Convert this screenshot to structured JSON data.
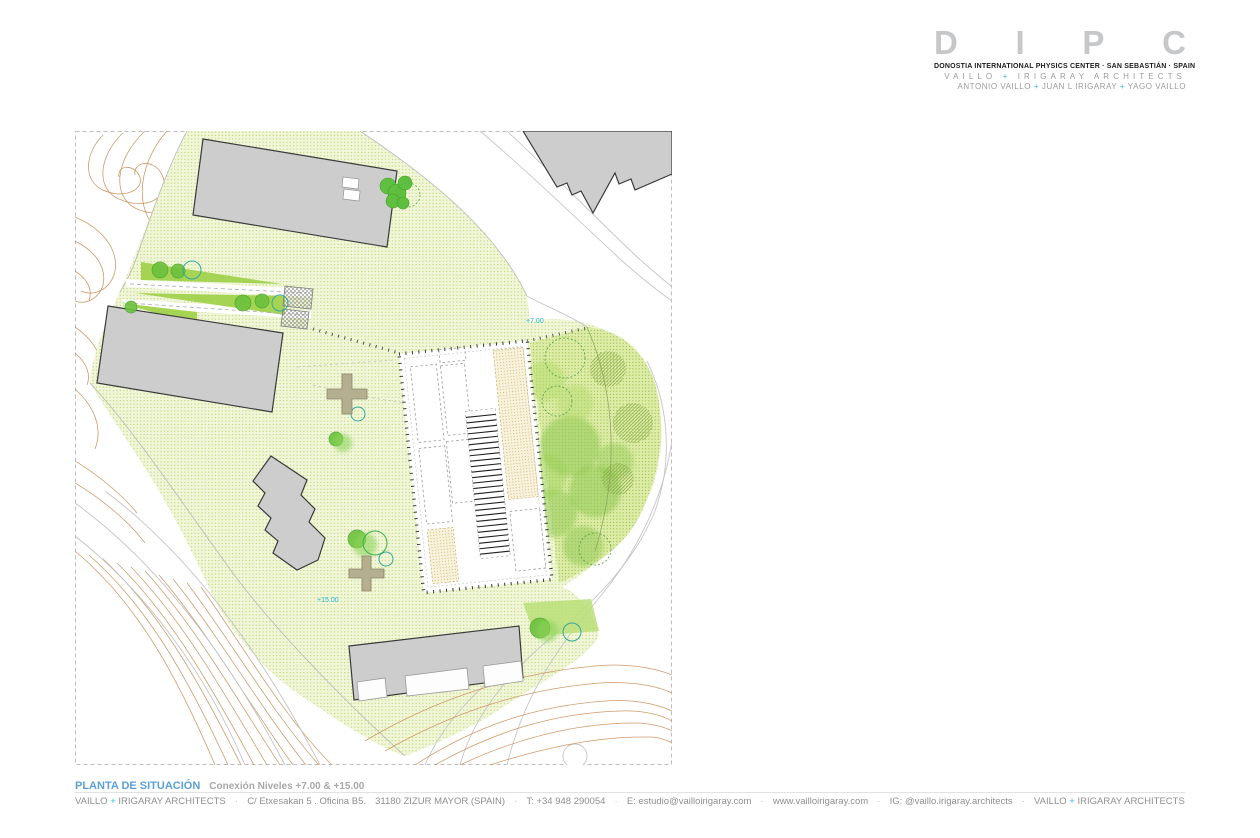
{
  "header": {
    "logo_letters": [
      "D",
      "I",
      "P",
      "C"
    ],
    "subtitle": "DONOSTIA INTERNATIONAL PHYSICS CENTER · SAN SEBASTIÁN · SPAIN",
    "firm_line": {
      "a": "VAILLO",
      "plus": "+",
      "b": "IRIGARAY ARCHITECTS"
    },
    "partners_line": {
      "a": "ANTONIO VAILLO",
      "plus1": "+",
      "b": "JUAN L IRIGARAY",
      "plus2": "+",
      "c": "YAGO VAILLO"
    }
  },
  "plan": {
    "labels": {
      "level_upper": "+7.00",
      "level_lower": "+15.00"
    }
  },
  "title_block": {
    "title": "PLANTA DE SITUACIÓN",
    "subtitle": "Conexión Niveles +7.00 & +15.00"
  },
  "footer": {
    "firm_a": "VAILLO",
    "plus": "+",
    "firm_b": "IRIGARAY ARCHITECTS",
    "sep": "·",
    "address": "C/ Etxesakan 5 . Oficina B5.",
    "city": "31180  ZIZUR MAYOR (SPAIN)",
    "phone": "T: +34 948 290054",
    "email": "E: estudio@vailloirigaray.com",
    "web": "www.vailloirigaray.com",
    "instagram": "IG: @vaillo.irigaray.architects",
    "firm2_a": "VAILLO",
    "plus2": "+",
    "firm2_b": "IRIGARAY ARCHITECTS"
  },
  "colors": {
    "accent_cyan": "#39b7dc",
    "title_blue": "#5b9fd4",
    "logo_gray": "#c6c7c9",
    "site_green_base": "#f1f6d9",
    "site_green_dot": "#b7d36e",
    "wedge_green": "#a5d455",
    "landscape_green": "#8cc74e",
    "contour_orange": "#cf9a69",
    "building_gray": "#cdcdcd",
    "tan_hatch": "#c9b261"
  }
}
